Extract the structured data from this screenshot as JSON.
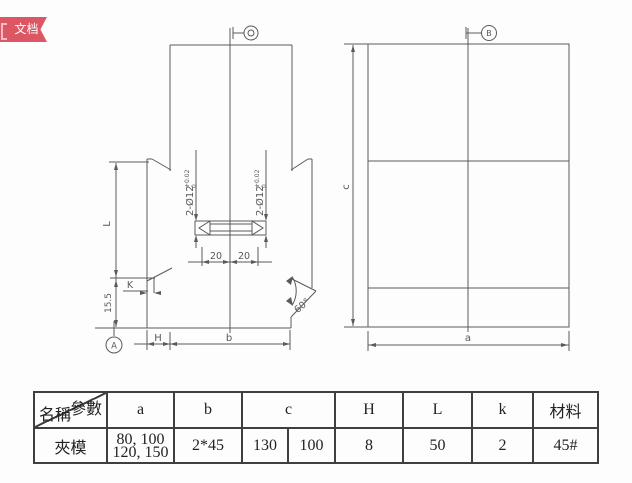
{
  "badge": {
    "label": "文档"
  },
  "drawing": {
    "front_view": {
      "hole_callout": {
        "text": "2-Ø12",
        "tol_up": "+0.02",
        "tol_dn": "0"
      },
      "dims": {
        "L": "L",
        "base_height": "15.5",
        "K": "K",
        "H": "H",
        "b": "b",
        "slot_left": "20",
        "slot_right": "20",
        "angle": "60°"
      },
      "datum": "A"
    },
    "side_view": {
      "dims": {
        "c": "c",
        "a": "a"
      },
      "datum": "B"
    }
  },
  "table": {
    "corner": {
      "top_right": "參數",
      "bottom_left": "名稱"
    },
    "headers": {
      "a": "a",
      "b": "b",
      "c": "c",
      "H": "H",
      "L": "L",
      "k": "k",
      "material": "材料"
    },
    "row": {
      "name": "夾模",
      "a_line1": "80, 100",
      "a_line2": "120, 150",
      "b": "2*45",
      "c1": "130",
      "c2": "100",
      "H": "8",
      "L": "50",
      "k": "2",
      "material": "45#"
    }
  }
}
